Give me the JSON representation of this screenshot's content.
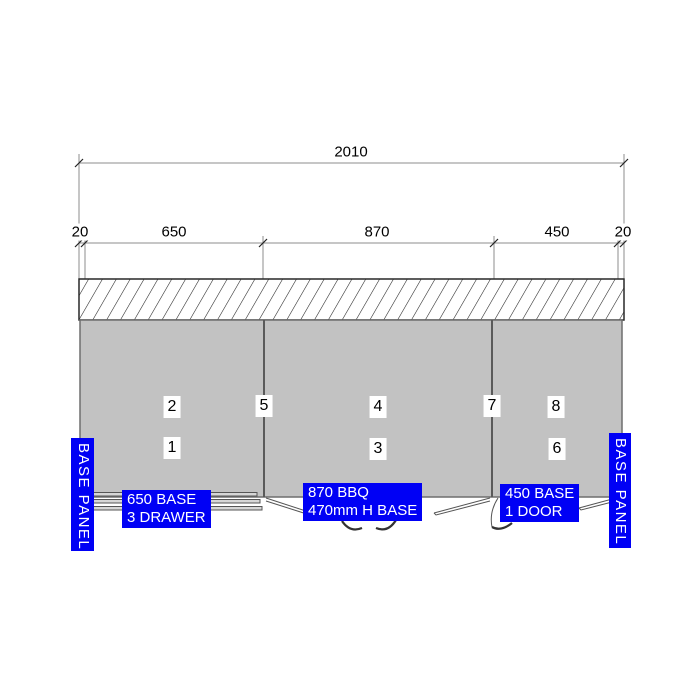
{
  "drawing_type": "cabinet-elevation",
  "colors": {
    "label_background": "#0000f5",
    "label_text": "#ffffff",
    "cabinet_fill": "#c2c2c2",
    "outline": "#5a5a5a",
    "dimension_line": "#8c8c8c",
    "text": "#000000"
  },
  "dimensions": {
    "overall": {
      "label": "2010"
    },
    "segments": [
      {
        "label": "20"
      },
      {
        "label": "650"
      },
      {
        "label": "870"
      },
      {
        "label": "450"
      },
      {
        "label": "20"
      }
    ]
  },
  "module_tags": [
    {
      "label": "2"
    },
    {
      "label": "1"
    },
    {
      "label": "5"
    },
    {
      "label": "4"
    },
    {
      "label": "3"
    },
    {
      "label": "7"
    },
    {
      "label": "8"
    },
    {
      "label": "6"
    }
  ],
  "labels": {
    "left_base_panel": "BASE PANEL",
    "right_base_panel": "BASE PANEL",
    "base_650": {
      "line1": "650 BASE",
      "line2": "3 DRAWER"
    },
    "base_870": {
      "line1": "870 BBQ",
      "line2": "470mm H BASE"
    },
    "base_450": {
      "line1": "450 BASE",
      "line2": "1 DOOR"
    }
  }
}
